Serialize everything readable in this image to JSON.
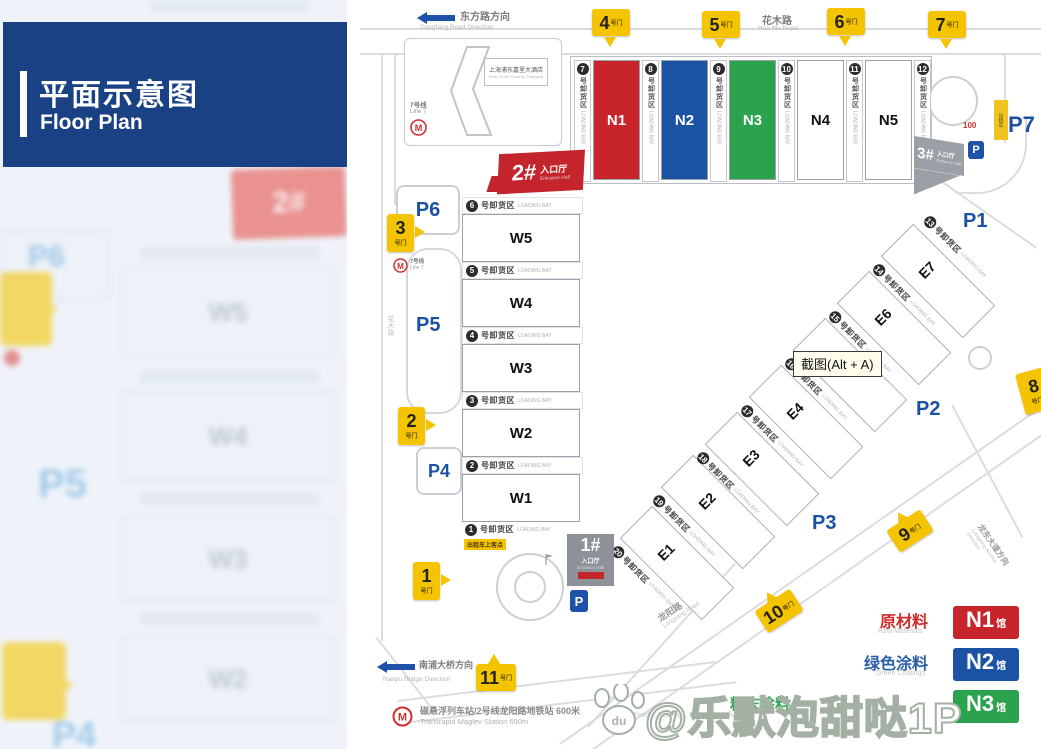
{
  "sidebar": {
    "title_zh": "平面示意图",
    "title_en": "Floor Plan"
  },
  "directions": {
    "dongfang_zh": "东方路方向",
    "dongfang_en": "Dongfang Road Direction",
    "huamu_zh": "花木路",
    "huamu_en": "Hua Mu Road",
    "nanpu_zh": "南浦大桥方向",
    "nanpu_en": "Nanpu Bridge Direction",
    "longyang_zh": "龙阳路",
    "longyang_en": "Longyang Road",
    "longdong_zh": "龙东大道方向",
    "longdong_en": "Longdong Avenue Direction"
  },
  "gates": {
    "suffix": "号门",
    "g1": "1",
    "g2": "2",
    "g3": "3",
    "g4": "4",
    "g5": "5",
    "g6": "6",
    "g7": "7",
    "g8": "8",
    "g9": "9",
    "g10": "10",
    "g11": "11"
  },
  "halls": {
    "n1": "N1",
    "n2": "N2",
    "n3": "N3",
    "n4": "N4",
    "n5": "N5",
    "w1": "W1",
    "w2": "W2",
    "w3": "W3",
    "w4": "W4",
    "w5": "W5",
    "e1": "E1",
    "e2": "E2",
    "e3": "E3",
    "e4": "E4",
    "e6": "E6",
    "e7": "E7"
  },
  "bays": {
    "zh": "号卸货区",
    "en": "LOADING BAY",
    "n": [
      "7",
      "8",
      "9",
      "10",
      "11",
      "12"
    ],
    "w": [
      "6",
      "5",
      "4",
      "3",
      "2",
      "1"
    ],
    "e": [
      "13",
      "14",
      "15",
      "16",
      "17",
      "18",
      "19",
      "20"
    ]
  },
  "parking": {
    "icon": "P",
    "p1": "P1",
    "p2": "P2",
    "p3": "P3",
    "p4": "P4",
    "p5": "P5",
    "p6": "P6",
    "p7": "P7"
  },
  "entrances": {
    "hall_zh": "入口厅",
    "hall_en": "Entrance Hall",
    "e1_num": "1#",
    "e2_num": "2#",
    "e3_num": "3#"
  },
  "landmarks": {
    "hotel_zh": "上海浦东嘉里大酒店",
    "hotel_en": "Kerry Hotel Pudong, Shanghai",
    "line7_zh": "7号线",
    "line7_en": "Line 7",
    "maglev_zh": "磁悬浮列车站/2号线龙阳路地铁站 600米",
    "maglev_en": "Transrapid Maglev Station 600m",
    "taxi_pickup": "出租车上客点",
    "taxi_stand": "出租车",
    "dist_100": "100"
  },
  "legend": {
    "rows": [
      {
        "zh": "原材料",
        "en": "Raw Materials",
        "hall": "N1",
        "hall_suffix": "馆",
        "color": "#c8242c"
      },
      {
        "zh": "绿色涂料",
        "en": "Green Coatings",
        "hall": "N2",
        "hall_suffix": "馆",
        "color": "#1c52a3"
      },
      {
        "zh": "粉末涂料",
        "en": "Powder Coatings, Raw Materials",
        "hall": "N3",
        "hall_suffix": "馆",
        "color": "#2ba24d"
      }
    ]
  },
  "overlay": {
    "tooltip": "截图(Alt + A)",
    "watermark": "@乐默泡甜哒1P"
  },
  "colors": {
    "header_blue": "#1a4184",
    "hall_red": "#c8242c",
    "hall_blue": "#1c52a3",
    "hall_green": "#2ba24d",
    "gate_yellow": "#f5c400",
    "parking_blue": "#1c52a3",
    "entrance_red": "#c4242b",
    "road_gray": "#dcdcdc"
  }
}
